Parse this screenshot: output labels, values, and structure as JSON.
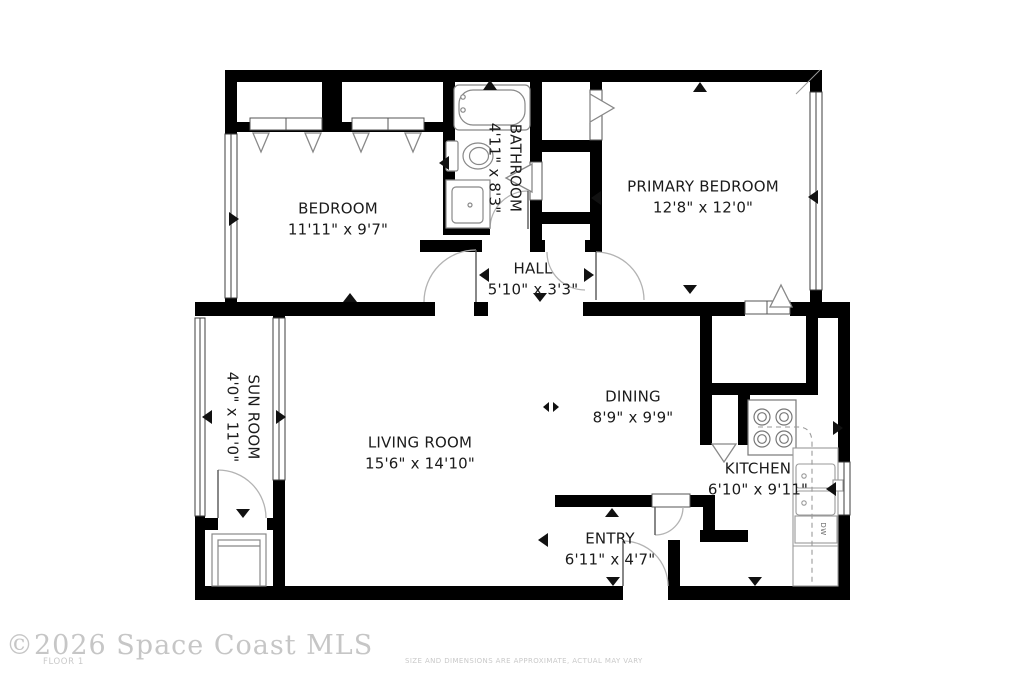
{
  "rooms": {
    "bedroom": {
      "name": "BEDROOM",
      "dims": "11'11\" x 9'7\""
    },
    "bathroom": {
      "name": "BATHROOM",
      "dims": "4'11\" x 8'3\""
    },
    "primary_bedroom": {
      "name": "PRIMARY BEDROOM",
      "dims": "12'8\" x 12'0\""
    },
    "hall": {
      "name": "HALL",
      "dims": "5'10\" x 3'3\""
    },
    "sun_room": {
      "name": "SUN ROOM",
      "dims": "4'0\" x 11'0\""
    },
    "living_room": {
      "name": "LIVING ROOM",
      "dims": "15'6\" x 14'10\""
    },
    "dining": {
      "name": "DINING",
      "dims": "8'9\" x 9'9\""
    },
    "kitchen": {
      "name": "KITCHEN",
      "dims": "6'10\" x 9'11\""
    },
    "entry": {
      "name": "ENTRY",
      "dims": "6'11\" x 4'7\""
    }
  },
  "labels": {
    "dishwasher": "DW"
  },
  "footer": {
    "copyright": "©2026 Space Coast MLS",
    "floor_label": "FLOOR 1",
    "disclaimer": "SIZE AND DIMENSIONS ARE APPROXIMATE, ACTUAL MAY VARY"
  },
  "colors": {
    "wall": "#000000",
    "fixture_outline": "#888888",
    "door_arc": "#b0b0b0",
    "label_text": "#1b1b1b",
    "footer_text": "#c6c6c6"
  }
}
